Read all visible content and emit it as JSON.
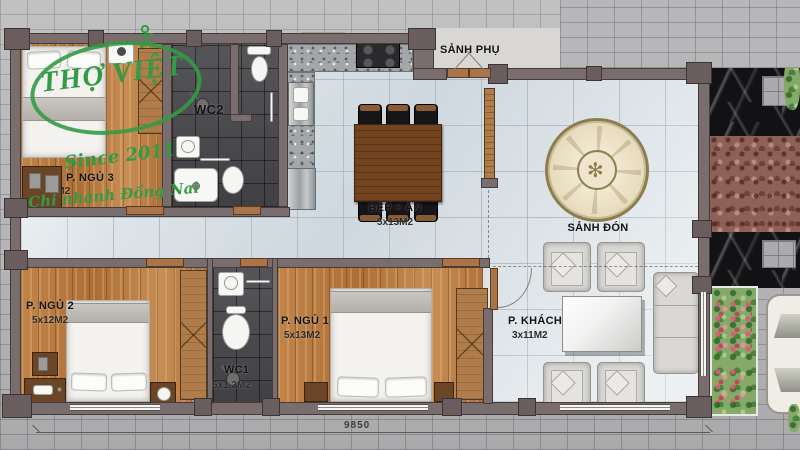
{
  "logo": {
    "brand": "THỢ VIỆT",
    "since": "Since 2011",
    "branch": "Chi nhánh Đồng Nai"
  },
  "rooms": {
    "bedroom3": {
      "name": "P. NGỦ 3",
      "size": "4x12M2"
    },
    "wc2": {
      "name": "WC2"
    },
    "kitchen_dining": {
      "name": "BẾP + ĂN",
      "size": "5x13M2"
    },
    "side_hall": {
      "name": "SẢNH PHỤ"
    },
    "main_hall": {
      "name": "SẢNH ĐÓN"
    },
    "bedroom2": {
      "name": "P. NGỦ 2",
      "size": "5x12M2"
    },
    "wc1": {
      "name": "WC1",
      "size": "5x1,3M2"
    },
    "bedroom1": {
      "name": "P. NGỦ 1",
      "size": "5x13M2"
    },
    "living": {
      "name": "P. KHÁCH",
      "size": "3x11M2"
    }
  },
  "dimensions": {
    "width": "9850"
  },
  "decor": {
    "medallion_glyph": "✻"
  },
  "colors": {
    "wood_floor": "#b8793f",
    "light_tile": "#dde4e8",
    "wc_tile": "#4b4b4f",
    "wall": "#7a6d6d",
    "logo_green": "#349a45",
    "black_marble": "#121214",
    "red_gravel": "#8f6056",
    "paver": "#b7b7b9"
  }
}
